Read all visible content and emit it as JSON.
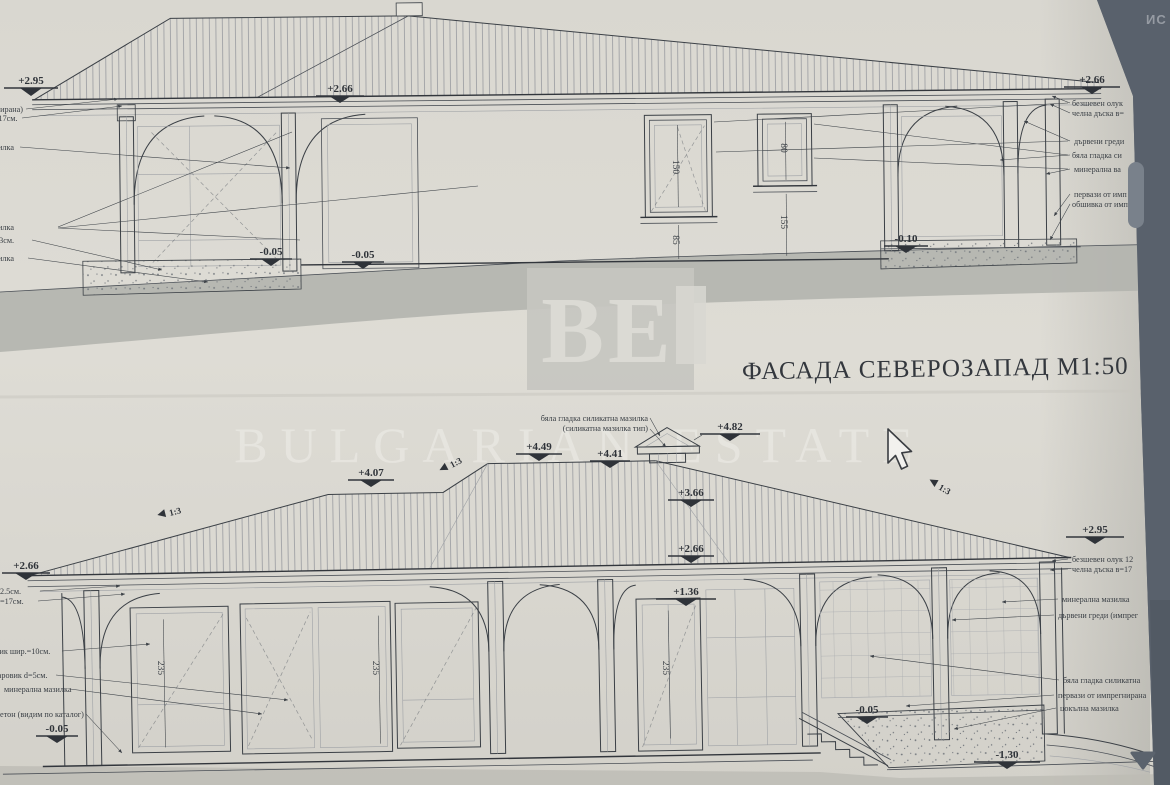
{
  "colors": {
    "background": "#59616c",
    "paper": "#dcdad3",
    "ink": "#3b4046",
    "terrain_band": "#b2b4ae",
    "watermark_box": "#c5c5c0"
  },
  "header": {
    "corner_text": "ИС"
  },
  "watermark": {
    "logo_text": "BE",
    "brand_text": "BULGARIAN ESTATE"
  },
  "title": {
    "text": "ФАСАДА СЕВЕРОЗАПАД М1:50"
  },
  "top_drawing": {
    "marks": {
      "left_eave": "+2.95",
      "mid_eave": "+2.66",
      "right_eave": "+2.66",
      "floor_a": "-0.05",
      "floor_b": "-0.05",
      "ground_right": "-0.10"
    },
    "dims": {
      "window1_height": "150",
      "window1_sill": "85",
      "window2_height": "80",
      "window2_sill": "155"
    },
    "left_notes": [
      "(импрегнирана)",
      "в=17см.",
      "мазилка",
      "мазилка",
      "и d=3см.",
      "мазилка"
    ],
    "right_notes": [
      "безшевен олук",
      "челна дъска в=",
      "дървени греди",
      "бяла гладка си",
      "минерална ва",
      "первази от имп",
      "обшивка от имп"
    ]
  },
  "bottom_drawing": {
    "marks": {
      "chimney_top": "+4.82",
      "ridge": "+4.49",
      "ridge2": "+4.41",
      "hip_left": "+4.07",
      "hip_right": "+3.66",
      "eave_mid": "+2.66",
      "door_top": "+1.36",
      "eave_left": "+2.66",
      "eave_right": "+2.95",
      "floor_left": "-0.05",
      "floor_right": "-0.05",
      "ground_low": "-1.30",
      "slope": "1:3"
    },
    "dims": {
      "opening_height": "235"
    },
    "chimney_notes": [
      "бяла гладка силикатна мазилка",
      "(силикатна мазилка тип)"
    ],
    "left_notes": [
      "2.5см.",
      "=17см.",
      "варовик шир.=10см.",
      "варовик d=5см.",
      "минерална мазилка",
      "бетон (видим по каталог)"
    ],
    "right_notes": [
      "безшевен олук 12",
      "челна дъска в=17",
      "минерална мазилка",
      "дървени греди (импрег",
      "бяла гладка силикатна",
      "первази от импрегнирана",
      "цокълна мазилка"
    ]
  }
}
